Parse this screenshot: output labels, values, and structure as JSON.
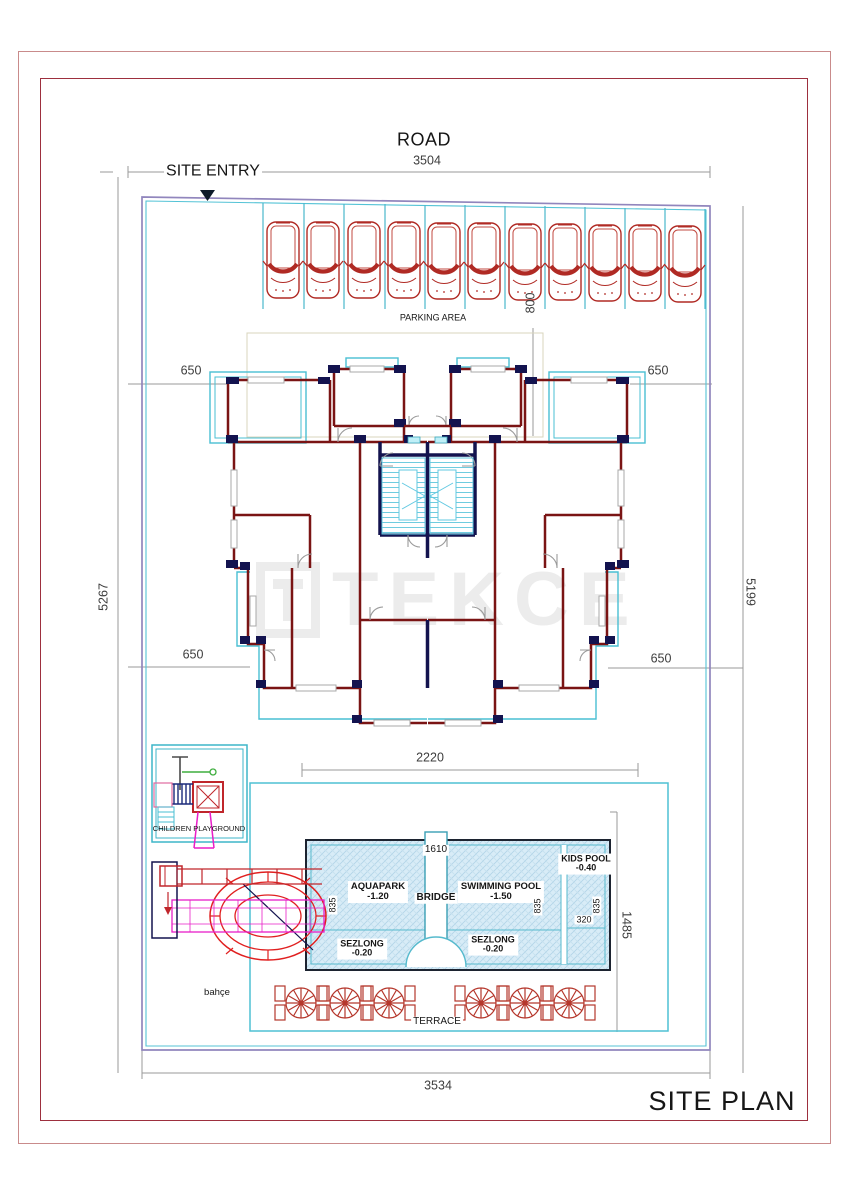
{
  "page": {
    "title": "SITE PLAN"
  },
  "labels": {
    "road": "ROAD",
    "site_entry": "SITE ENTRY",
    "parking_area": "PARKING AREA",
    "children_playground": "CHILDREN PLAYGROUND",
    "garden": "bahçe",
    "terrace": "TERRACE",
    "site_plan": "SITE PLAN",
    "watermark": "TEKCE"
  },
  "dims": {
    "top_width": "3504",
    "bottom_width": "3534",
    "left_depth": "5267",
    "right_depth": "5199",
    "parking_depth": "800",
    "building_width": "2220",
    "offset_top_left": "650",
    "offset_top_right": "650",
    "offset_bottom_left": "650",
    "offset_bottom_right": "650",
    "bridge_top": "1610",
    "aquapark_width": "835",
    "pool_width": "835",
    "kids_pool_width_outer": "835",
    "kids_pool_inner": "320",
    "pool_area_depth": "1485"
  },
  "pool": {
    "aquapark_label": "AQUAPARK",
    "aquapark_level": "-1.20",
    "bridge_label": "BRIDGE",
    "swimming_label": "SWIMMING POOL",
    "swimming_level": "-1.50",
    "kids_label": "KIDS POOL",
    "kids_level": "-0.40",
    "sezlong_left_label": "SEZLONG",
    "sezlong_left_level": "-0.20",
    "sezlong_right_label": "SEZLONG",
    "sezlong_right_level": "-0.20"
  },
  "parking": {
    "car_count": 11
  },
  "colors": {
    "border_outer": "#c98b8b",
    "border_inner": "#9d2f3e",
    "boundary_purple": "#9186bd",
    "cad_cyan": "#4ec1d4",
    "wall_red": "#7a1414",
    "wall_navy": "#13134f",
    "car_red": "#b02a24",
    "pool_fill": "#d8ecf7",
    "slide_magenta": "#e81ec8",
    "swing_green": "#3fae3f",
    "dim_grey": "#9a9a9a"
  }
}
